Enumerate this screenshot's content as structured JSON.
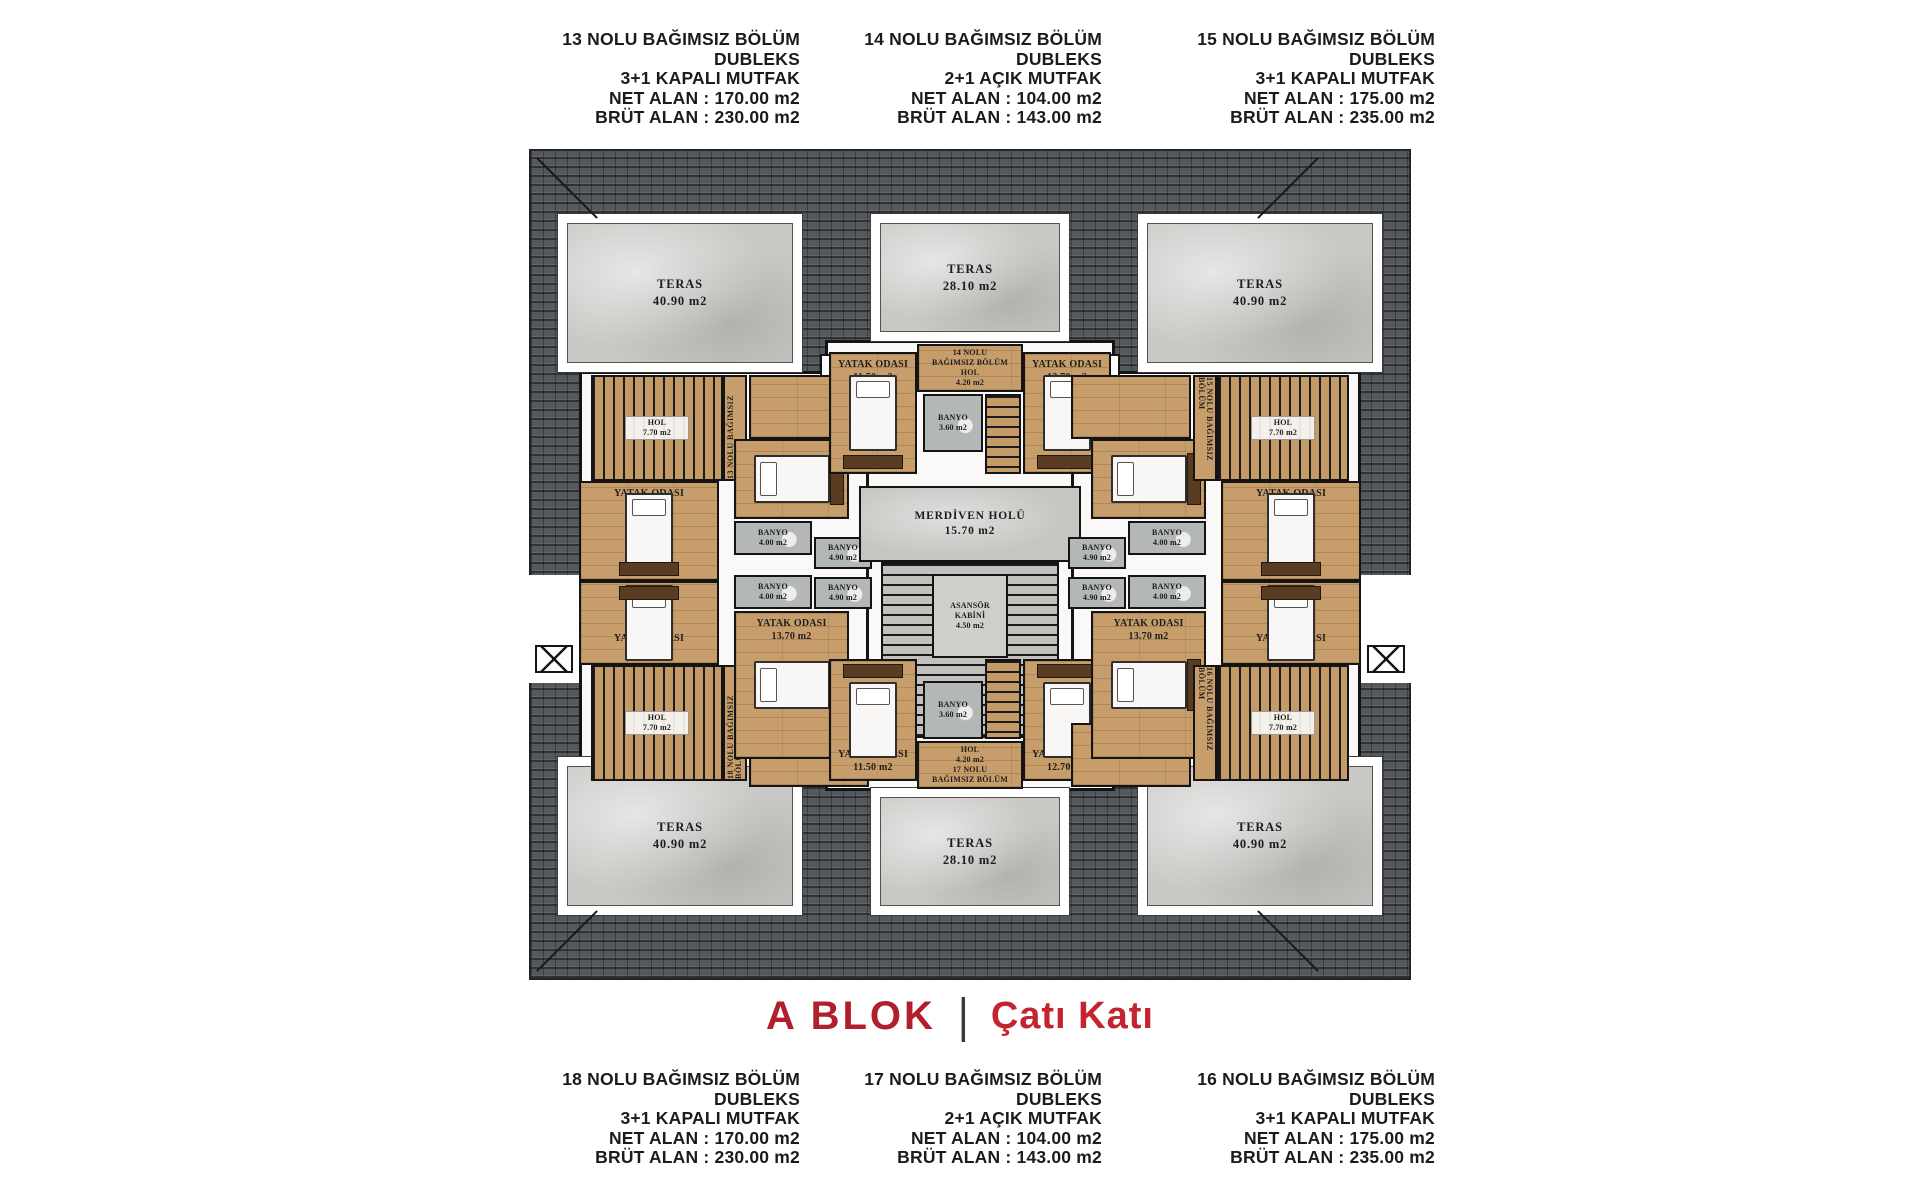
{
  "title": {
    "block": "A BLOK",
    "divider": "|",
    "floor": "Çatı Katı"
  },
  "colors": {
    "accent_red": "#b01f2b",
    "accent_red_light": "#c4242f",
    "roof_gray": "#55595d",
    "wood": "#c79e6b",
    "marble": "#c9c8c5",
    "wall": "#141414",
    "bath_gray": "#b4b7b7"
  },
  "header_units": [
    {
      "name": "13 NOLU BAĞIMSIZ BÖLÜM",
      "type": "DUBLEKS",
      "kitchen": "3+1 KAPALI MUTFAK",
      "net": "NET ALAN : 170.00 m2",
      "brut": "BRÜT ALAN : 230.00 m2"
    },
    {
      "name": "14 NOLU BAĞIMSIZ BÖLÜM",
      "type": "DUBLEKS",
      "kitchen": "2+1 AÇIK MUTFAK",
      "net": "NET ALAN : 104.00 m2",
      "brut": "BRÜT ALAN : 143.00 m2"
    },
    {
      "name": "15 NOLU BAĞIMSIZ BÖLÜM",
      "type": "DUBLEKS",
      "kitchen": "3+1 KAPALI MUTFAK",
      "net": "NET ALAN : 175.00 m2",
      "brut": "BRÜT ALAN : 235.00 m2"
    }
  ],
  "footer_units": [
    {
      "name": "18 NOLU BAĞIMSIZ BÖLÜM",
      "type": "DUBLEKS",
      "kitchen": "3+1 KAPALI MUTFAK",
      "net": "NET ALAN : 170.00 m2",
      "brut": "BRÜT ALAN : 230.00 m2"
    },
    {
      "name": "17 NOLU BAĞIMSIZ BÖLÜM",
      "type": "DUBLEKS",
      "kitchen": "2+1 AÇIK MUTFAK",
      "net": "NET ALAN : 104.00 m2",
      "brut": "BRÜT ALAN : 143.00 m2"
    },
    {
      "name": "16 NOLU BAĞIMSIZ BÖLÜM",
      "type": "DUBLEKS",
      "kitchen": "3+1 KAPALI MUTFAK",
      "net": "NET ALAN : 175.00 m2",
      "brut": "BRÜT ALAN : 235.00 m2"
    }
  ],
  "plan": {
    "labels": {
      "teras_40": [
        "TERAS",
        "40.90 m2"
      ],
      "teras_28": [
        "TERAS",
        "28.10 m2"
      ],
      "merdiven": [
        "MERDİVEN HOLÜ",
        "15.70 m2"
      ],
      "asansor": [
        "ASANSÖR",
        "KABİNİ",
        "4.50 m2"
      ],
      "hol_770": [
        "HOL",
        "7.70 m2"
      ],
      "banyo_360": [
        "BANYO",
        "3.60 m2"
      ],
      "banyo_400": [
        "BANYO",
        "4.00 m2"
      ],
      "banyo_490": [
        "BANYO",
        "4.90 m2"
      ],
      "bed_1500": [
        "YATAK ODASI",
        "15.00 m2"
      ],
      "bed_1370": [
        "YATAK ODASI",
        "13.70 m2"
      ],
      "bed_1150": [
        "YATAK ODASI",
        "11.50 m2"
      ],
      "bed_1270": [
        "YATAK ODASI",
        "12.70 m2"
      ],
      "unit14_hall": [
        "14 NOLU",
        "BAĞIMSIZ BÖLÜM",
        "HOL",
        "4.20 m2"
      ],
      "unit17_hall": [
        "HOL",
        "4.20 m2",
        "17 NOLU",
        "BAĞIMSIZ BÖLÜM"
      ],
      "unit13_v": "13 NOLU BAĞIMSIZ BÖLÜM",
      "unit15_v": "15 NOLU BAĞIMSIZ BÖLÜM",
      "unit16_v": "16 NOLU BAĞIMSIZ BÖLÜM",
      "unit18_v": "18 NOLU BAĞIMSIZ BÖLÜM"
    }
  }
}
